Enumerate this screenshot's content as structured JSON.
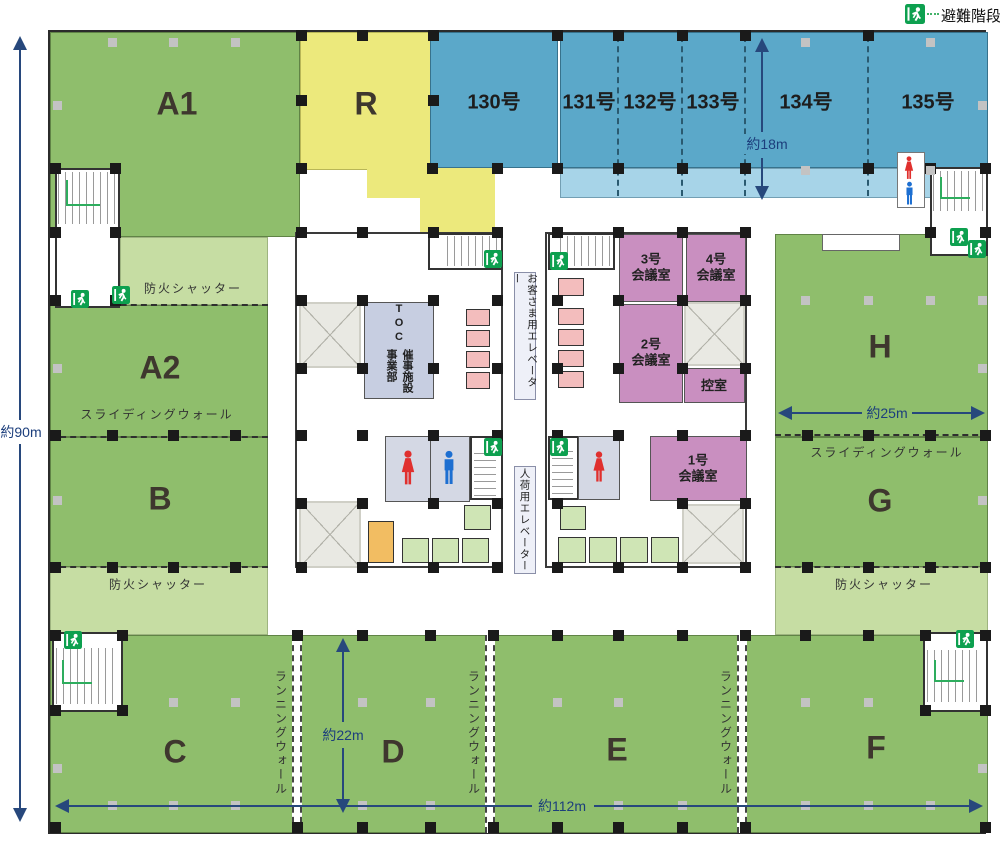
{
  "legend": {
    "escape_stairs": "避難階段"
  },
  "zones": {
    "a1": "A1",
    "a2": "A2",
    "b": "B",
    "c": "C",
    "d": "D",
    "e": "E",
    "f": "F",
    "g": "G",
    "h": "H",
    "r": "R",
    "blue_rooms": [
      "130号",
      "131号",
      "132号",
      "133号",
      "134号",
      "135号"
    ]
  },
  "core": {
    "toc_en": "TOC",
    "toc_jp": "催事施設事業部",
    "rooms": {
      "m1": "1号\n会議室",
      "m2": "2号\n会議室",
      "m3": "3号\n会議室",
      "m4": "4号\n会議室",
      "waiting": "控室"
    }
  },
  "elevators": {
    "customer": "お客さま用エレベーター",
    "freight": "人荷用エレベーター"
  },
  "wall_labels": {
    "fire_shutter": "防火シャッター",
    "sliding_wall": "スライディングウォール",
    "running_wall": "ランニングウォール"
  },
  "dimensions": {
    "left": "約90m",
    "bottom": "約112m",
    "center": "約22m",
    "right": "約25m",
    "top_right": "約18m"
  },
  "colors": {
    "zone_green": "#8fbe6c",
    "zone_green_light": "#c6dda3",
    "zone_yellow": "#ece97c",
    "zone_blue": "#5ba8c9",
    "zone_blue_light": "#a7d4e8",
    "meeting_pink": "#c98fc0",
    "elevator_pink": "#f3bdbd",
    "elevator_green": "#cfe5b5",
    "elevator_orange": "#f2bd62",
    "exit_green": "#0da04f",
    "dimension_navy": "#27487c"
  }
}
